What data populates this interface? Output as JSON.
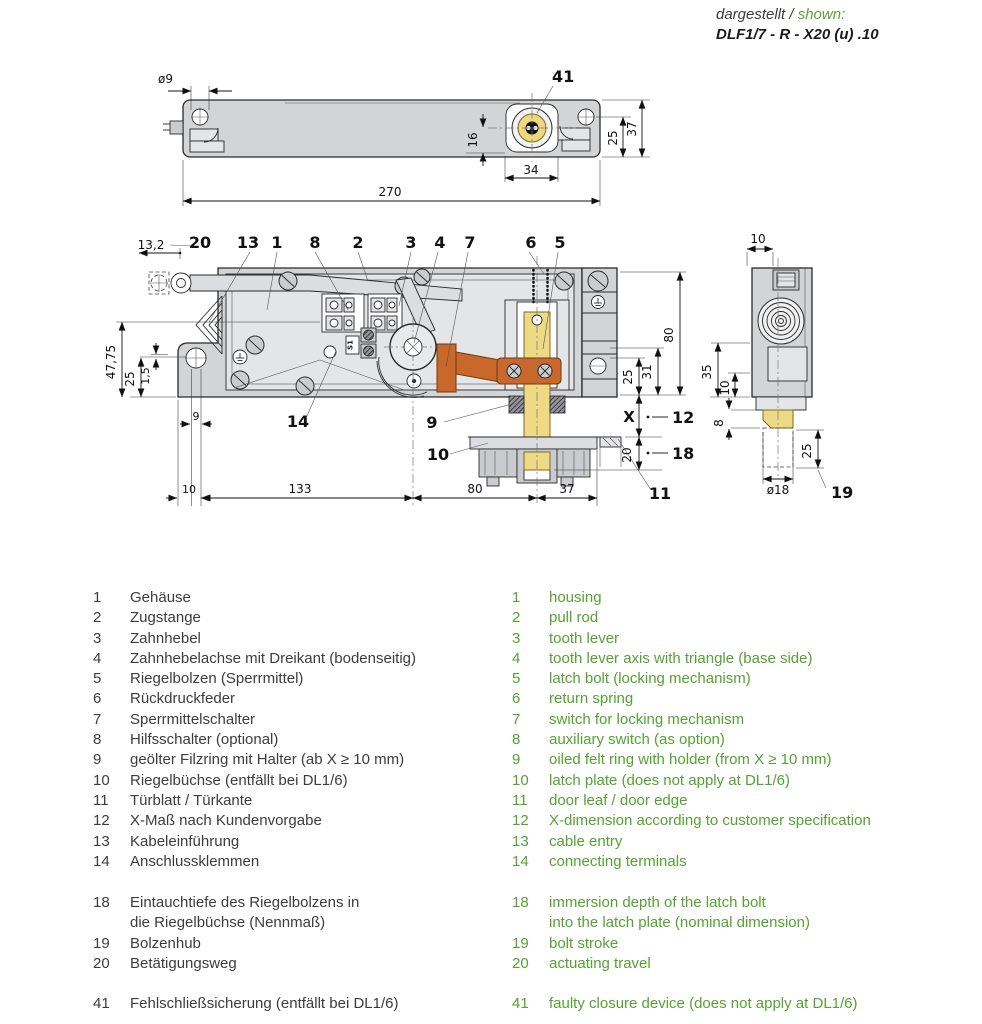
{
  "header": {
    "shown_label_de": "dargestellt /",
    "shown_label_en": " shown:",
    "model": "DLF1/7 - R - X20 (u) .10"
  },
  "colors": {
    "legend_green": "#55a233",
    "latch_bolt_yellow": "#eed985",
    "switch_orange": "#c8682a",
    "housing_gray": "#d2d4d6",
    "line_dark": "#2a2a2a"
  },
  "top_view": {
    "part_41": "41",
    "dim_hole": "ø9",
    "dim_16": "16",
    "dim_34": "34",
    "dim_270": "270",
    "dim_25": "25",
    "dim_37": "37"
  },
  "front_view": {
    "part_20": "20",
    "part_13": "13",
    "part_1": "1",
    "part_8": "8",
    "part_2": "2",
    "part_3": "3",
    "part_4": "4",
    "part_7": "7",
    "part_6": "6",
    "part_5": "5",
    "part_14": "14",
    "part_9": "9",
    "part_10": "10",
    "part_11": "11",
    "part_12": "12",
    "part_18": "18",
    "dim_x": "X",
    "dim_13_2": "13,2",
    "dim_47_75": "47,75",
    "dim_25_left": "25",
    "dim_1_5": "1,5",
    "dim_9": "9",
    "dim_10": "10",
    "dim_133": "133",
    "dim_80_bottom": "80",
    "dim_37": "37",
    "dim_80_right": "80",
    "dim_31": "31",
    "dim_25_right": "25",
    "dim_20_right": "20",
    "marking_s1": "S1"
  },
  "side_view": {
    "dim_10_top": "10",
    "dim_35": "35",
    "dim_10_left": "10",
    "dim_8": "8",
    "dim_25": "25",
    "dim_d18": "ø18",
    "part_19": "19"
  },
  "legend": {
    "items": [
      {
        "no": "1",
        "de": "Gehäuse",
        "en": "housing"
      },
      {
        "no": "2",
        "de": "Zugstange",
        "en": "pull rod"
      },
      {
        "no": "3",
        "de": "Zahnhebel",
        "en": "tooth lever"
      },
      {
        "no": "4",
        "de": "Zahnhebelachse mit Dreikant (bodenseitig)",
        "en": "tooth lever axis with triangle (base side)"
      },
      {
        "no": "5",
        "de": "Riegelbolzen (Sperrmittel)",
        "en": "latch bolt (locking mechanism)"
      },
      {
        "no": "6",
        "de": "Rückdruckfeder",
        "en": "return spring"
      },
      {
        "no": "7",
        "de": "Sperrmittelschalter",
        "en": "switch for locking mechanism"
      },
      {
        "no": "8",
        "de": "Hilfsschalter (optional)",
        "en": "auxiliary switch (as option)"
      },
      {
        "no": "9",
        "de": "geölter Filzring mit Halter (ab X ≥ 10 mm)",
        "en": "oiled felt ring with holder (from X ≥ 10 mm)"
      },
      {
        "no": "10",
        "de": "Riegelbüchse (entfällt bei DL1/6)",
        "en": "latch plate (does not apply at DL1/6)"
      },
      {
        "no": "11",
        "de": "Türblatt / Türkante",
        "en": "door leaf / door edge"
      },
      {
        "no": "12",
        "de": "X-Maß nach Kundenvorgabe",
        "en": "X-dimension according to customer specification"
      },
      {
        "no": "13",
        "de": "Kabeleinführung",
        "en": "cable entry"
      },
      {
        "no": "14",
        "de": "Anschlussklemmen",
        "en": "connecting terminals"
      }
    ],
    "items_dims": [
      {
        "no": "18",
        "de": "Eintauchtiefe des Riegelbolzens in\ndie Riegelbüchse (Nennmaß)",
        "en": "immersion depth of the latch bolt\ninto the latch plate (nominal dimension)"
      },
      {
        "no": "19",
        "de": "Bolzenhub",
        "en": "bolt stroke"
      },
      {
        "no": "20",
        "de": "Betätigungsweg",
        "en": "actuating travel"
      }
    ],
    "items_extra": [
      {
        "no": "41",
        "de": "Fehlschließsicherung (entfällt bei DL1/6)",
        "en": "faulty closure device (does not apply at DL1/6)"
      }
    ]
  }
}
